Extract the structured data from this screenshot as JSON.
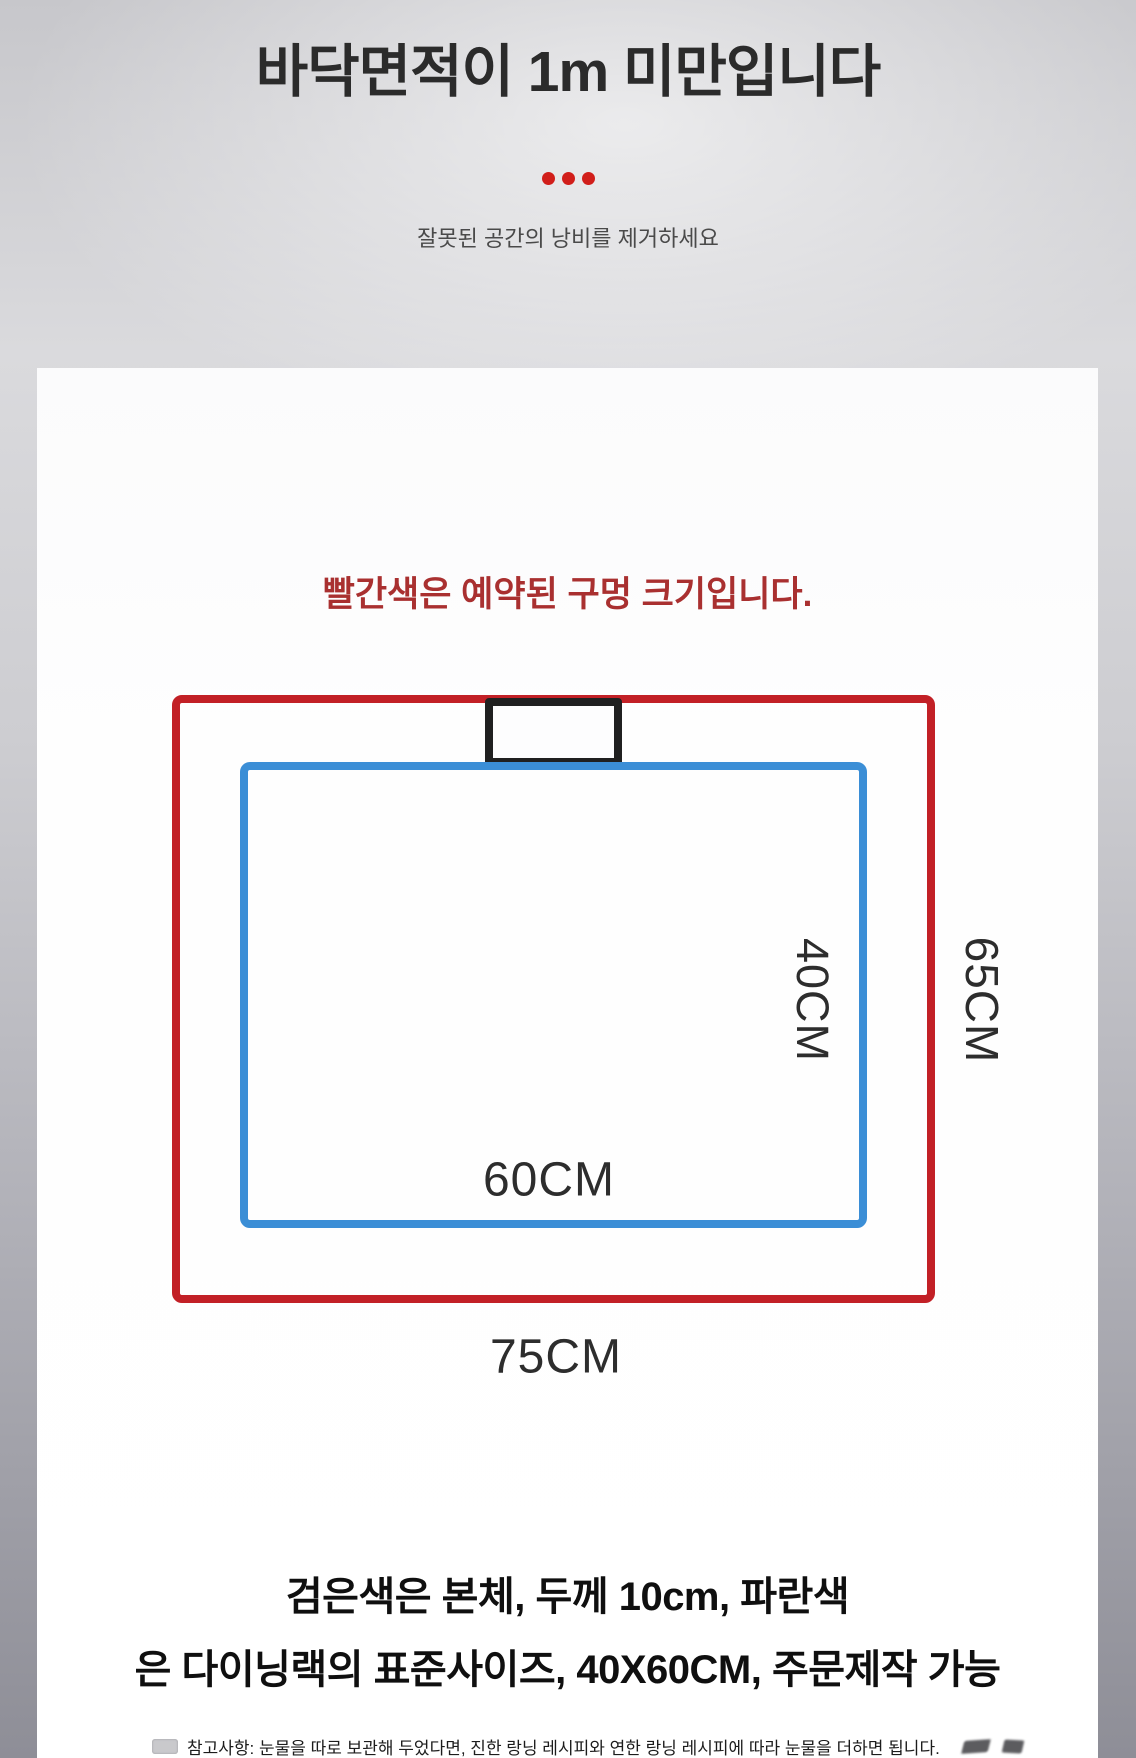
{
  "header": {
    "title": "바닥면적이 1m 미만입니다",
    "subtitle": "잘못된 공간의 낭비를 제거하세요"
  },
  "diagram": {
    "caption": "빨간색은 예약된 구멍 크기입니다.",
    "inner_height_label": "40CM",
    "outer_height_label": "65CM",
    "inner_width_label": "60CM",
    "outer_width_label": "75CM"
  },
  "footer": {
    "line1": "검은색은 본체, 두께 10cm, 파란색",
    "line2": "은 다이닝랙의 표준사이즈, 40X60CM, 주문제작 가능",
    "note": "참고사항: 눈물을 따로 보관해 두었다면, 진한 랑닝 레시피와 연한 랑닝 레시피에 따라 눈물을 더하면 됩니다."
  },
  "colors": {
    "outer_rect_red": "#c22026",
    "inner_rect_blue": "#3b8ed6",
    "body_rect_black": "#202020",
    "divider_dot_red": "#d11e1a",
    "caption_red": "#a93030"
  },
  "icons": {
    "dots_divider": "three-dots-divider-icon",
    "note_prefix": "memo-icon",
    "note_suffix": "smudge-marks-icon"
  }
}
